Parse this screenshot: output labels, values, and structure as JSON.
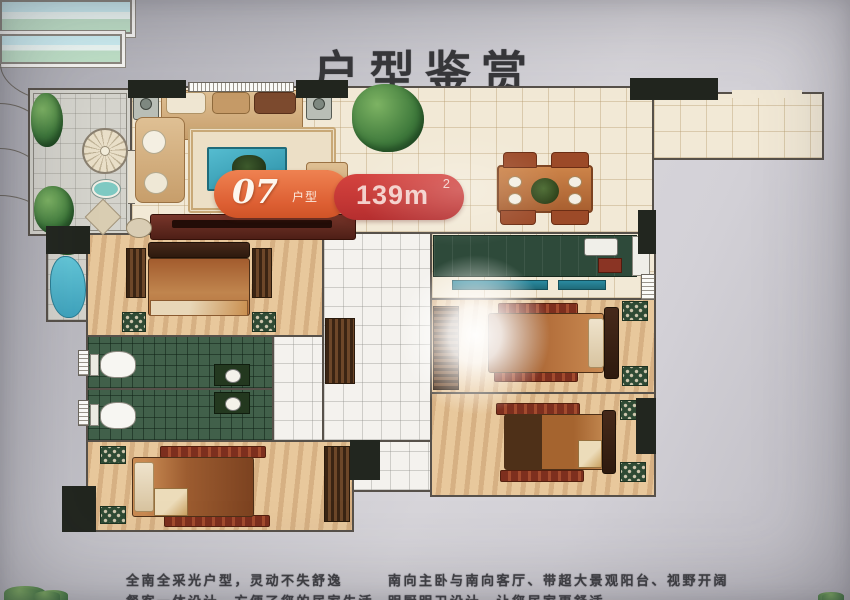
{
  "title": "户型鉴赏",
  "unit_badge": {
    "number": "07",
    "number_label": "户型",
    "area": "139m",
    "area_sup": "2"
  },
  "footer": {
    "line1_left": "全南全采光户型，灵动不失舒逸",
    "line1_right": "南向主卧与南向客厅、带超大景观阳台、视野开阔",
    "line2_left": "餐客一体设计，方便了您的居家生活",
    "line2_right": "明厨明卫设计，让您居家更舒适"
  },
  "colors": {
    "badge_orange": "#dd5f33",
    "badge_red": "#c23634",
    "title_text": "#37373a",
    "plan_paper": "#f2e9d6",
    "wall": "#57514a",
    "bath_tile": "#41604a",
    "coffee_table_teal": "#3fa8c0",
    "photo_background": "#cac9cf"
  }
}
